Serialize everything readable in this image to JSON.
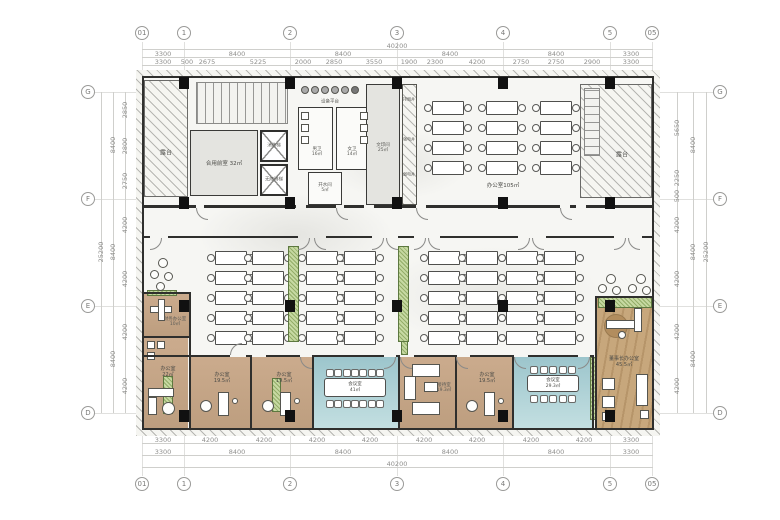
{
  "grid": {
    "columns": [
      "01",
      "1",
      "2",
      "3",
      "4",
      "5",
      "05"
    ],
    "rows": [
      "G",
      "F",
      "E",
      "D"
    ]
  },
  "dims": {
    "top": {
      "overall": "40200",
      "major": [
        "3300",
        "8400",
        "8400",
        "8400",
        "8400",
        "3300"
      ],
      "minor": [
        "3300",
        "500",
        "2675",
        "5225",
        "2000",
        "2850",
        "3550",
        "1900",
        "2300",
        "4200",
        "2750",
        "2750",
        "2900",
        "3300"
      ]
    },
    "bottom": {
      "overall": "40200",
      "major": [
        "3300",
        "8400",
        "8400",
        "8400",
        "8400",
        "3300"
      ],
      "minor": [
        "3300",
        "4200",
        "4200",
        "4200",
        "4200",
        "4200",
        "4200",
        "4200",
        "4200",
        "3300"
      ]
    },
    "left": {
      "overall": "25200",
      "major": [
        "8400",
        "8400",
        "8400"
      ],
      "minor": [
        "2850",
        "2800",
        "2750",
        "4200",
        "4200",
        "4200",
        "4200"
      ]
    },
    "right": {
      "overall": "25200",
      "major": [
        "8400",
        "8400",
        "8400"
      ],
      "minor": [
        "5650",
        "2250",
        "500",
        "4200",
        "4200",
        "4200",
        "4200"
      ]
    }
  },
  "rooms": {
    "terrace_left": {
      "name": "露台"
    },
    "terrace_right": {
      "name": "露台"
    },
    "shared_lobby": {
      "name": "合用前室",
      "area": "32㎡"
    },
    "mens_wc": {
      "name": "男卫",
      "area": "16㎡"
    },
    "womens_wc": {
      "name": "女卫",
      "area": "14㎡"
    },
    "hot_water": {
      "name": "开水间",
      "area": "5㎡"
    },
    "print_room": {
      "name": "文印间",
      "area": "25㎡"
    },
    "equipment_platform": {
      "name": "设备平台"
    },
    "smoke_shaft": {
      "name": "排烟井"
    },
    "power_shaft": {
      "name": "强电井"
    },
    "telecom_shaft": {
      "name": "弱电井"
    },
    "elevator_fire": {
      "name": "消防梯"
    },
    "elevator_accessible": {
      "name": "无障碍梯"
    },
    "office_north": {
      "name": "办公室",
      "area": "105㎡"
    },
    "finance_office": {
      "name": "财务办公室",
      "area": "10㎡"
    },
    "office_22": {
      "name": "办公室",
      "area": "22㎡"
    },
    "office_19_a": {
      "name": "办公室",
      "area": "19.5㎡"
    },
    "office_19_b": {
      "name": "办公室",
      "area": "19.5㎡"
    },
    "office_19_c": {
      "name": "办公室",
      "area": "19.5㎡"
    },
    "meeting_large": {
      "name": "会议室",
      "area": "41㎡"
    },
    "reception": {
      "name": "接待室",
      "area": "19.3㎡"
    },
    "meeting_small": {
      "name": "会议室",
      "area": "29.3㎡"
    },
    "ceo_office": {
      "name": "董事长办公室",
      "area": "45.5㎡"
    }
  },
  "colors": {
    "meeting_floor": "#a4cbd1",
    "office_floor": "#c6a98c",
    "wood_floor": "#c7a77c",
    "cabinet_green": "#c6d9a2",
    "wall": "#2f2f2d",
    "floor": "#f6f6f3"
  }
}
